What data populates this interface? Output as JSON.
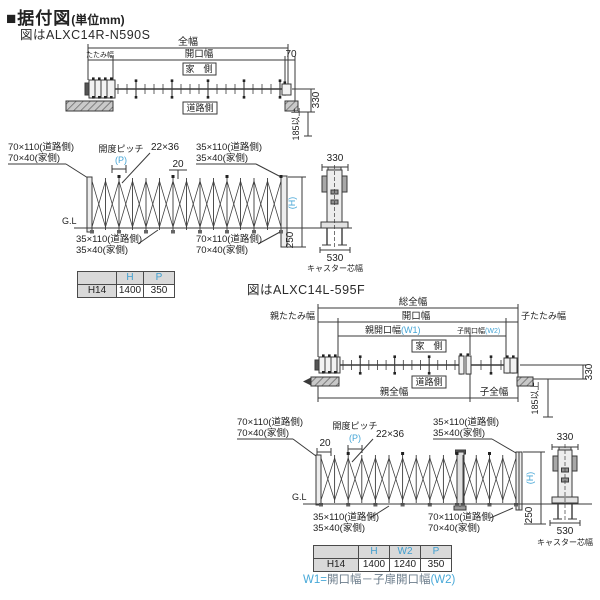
{
  "header": {
    "title_block": "■据付図",
    "title_unit": "(単位mm)"
  },
  "colors": {
    "accent_blue": "#45a5d6",
    "line": "#3a3a3a",
    "table_header_bg": "#d9d9d9"
  },
  "figure1": {
    "caption": "図はALXC14R-N590S",
    "plan": {
      "total_width": "全幅",
      "fold_width": "たたみ幅",
      "opening_width": "開口幅",
      "post_dim": "70",
      "house_side": "家　側",
      "road_side": "道路側",
      "depth": "330",
      "clearance": "185以上"
    },
    "elevation": {
      "top_left_l1": "70×110(道路側)",
      "top_left_l2": "70×40(家側)",
      "pitch": "開度ピッチ",
      "pitch_p": "(P)",
      "lattice_dim": "22×36",
      "top_gap": "20",
      "top_right_l1": "35×110(道路側)",
      "top_right_l2": "35×40(家側)",
      "ground": "G.L",
      "height": "(H)",
      "embed": "250",
      "bottom_left_l1": "35×110(道路側)",
      "bottom_left_l2": "35×40(家側)",
      "bottom_right_l1": "70×110(道路側)",
      "bottom_right_l2": "70×40(家側)"
    },
    "side": {
      "width": "330",
      "caster_width": "530",
      "caster_label": "キャスター芯幅"
    },
    "table": {
      "headers": [
        "",
        "H",
        "P"
      ],
      "row": [
        "H14",
        "1400",
        "350"
      ]
    }
  },
  "figure2": {
    "caption": "図はALXC14L-595F",
    "plan": {
      "total_width": "総全幅",
      "parent_fold": "親たたみ幅",
      "opening_width": "開口幅",
      "child_fold": "子たたみ幅",
      "parent_opening": "親開口幅",
      "parent_opening_code": "(W1)",
      "child_opening": "子開口幅",
      "child_opening_code": "(W2)",
      "house_side": "家　側",
      "road_side": "道路側",
      "parent_total": "親全幅",
      "child_total": "子全幅",
      "depth": "330",
      "clearance": "185以上"
    },
    "elevation": {
      "top_left_l1": "70×110(道路側)",
      "top_left_l2": "70×40(家側)",
      "pitch": "開度ピッチ",
      "pitch_p": "(P)",
      "lattice_dim": "22×36",
      "top_gap": "20",
      "top_right_l1": "35×110(道路側)",
      "top_right_l2": "35×40(家側)",
      "ground": "G.L",
      "height": "(H)",
      "embed": "250",
      "bottom_left_l1": "35×110(道路側)",
      "bottom_left_l2": "35×40(家側)",
      "bottom_right_l1": "70×110(道路側)",
      "bottom_right_l2": "70×40(家側)"
    },
    "side": {
      "width": "330",
      "caster_width": "530",
      "caster_label": "キャスター芯幅"
    },
    "table": {
      "headers": [
        "",
        "H",
        "W2",
        "P"
      ],
      "row": [
        "H14",
        "1400",
        "1240",
        "350"
      ]
    },
    "note": {
      "lhs": "W1=",
      "body": "開口幅－子扉開口幅",
      "rhs": "(W2)"
    }
  }
}
